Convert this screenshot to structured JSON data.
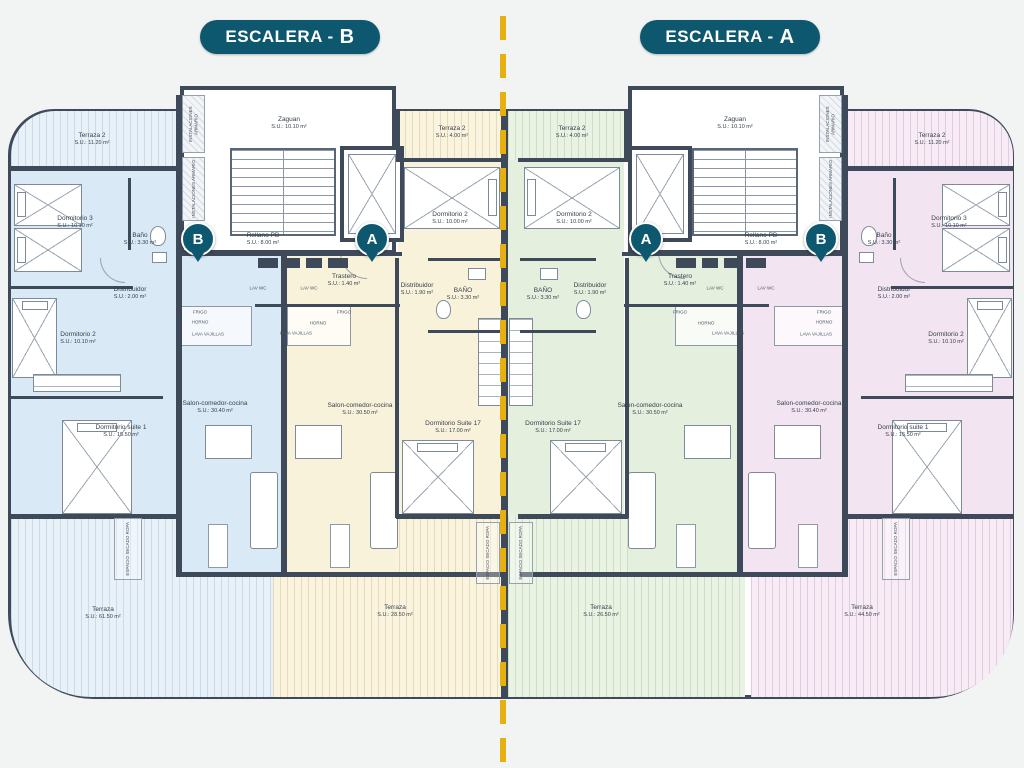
{
  "titles": {
    "b": {
      "prefix": "ESCALERA -",
      "letter": "B"
    },
    "a": {
      "prefix": "ESCALERA -",
      "letter": "A"
    }
  },
  "markers": {
    "b": "B",
    "a": "A"
  },
  "rooms": {
    "terraza2_large": {
      "name": "Terraza 2",
      "area": "S.U.: 11.20 m²"
    },
    "terraza2_small": {
      "name": "Terraza 2",
      "area": "S.U.: 4.00 m²"
    },
    "dormitorio3": {
      "name": "Dormitorio 3",
      "area": "S.U.: 10.10 m²"
    },
    "dormitorio2_side": {
      "name": "Dormitorio 2",
      "area": "S.U.: 10.10 m²"
    },
    "dormitorio2_center": {
      "name": "Dormitorio 2",
      "area": "S.U.: 10.00 m²"
    },
    "bano_side": {
      "name": "Baño",
      "area": "S.U.: 3.30 m²"
    },
    "bano_center": {
      "name": "BAÑO",
      "area": "S.U.: 3.30 m²"
    },
    "distribuidor_side": {
      "name": "Distribuidor",
      "area": "S.U.: 2.00 m²"
    },
    "distribuidor_center": {
      "name": "Distribuidor",
      "area": "S.U.: 1.90 m²"
    },
    "suite1": {
      "name": "Dormitorio suite 1",
      "area": "S.U.: 15.50 m²"
    },
    "suite17": {
      "name": "Dormitorio Suite 17",
      "area": "S.U.: 17.00 m²"
    },
    "salon_side": {
      "name": "Salon-comedor-cocina",
      "area": "S.U.: 30.40 m²"
    },
    "salon_center": {
      "name": "Salon-comedor-cocina",
      "area": "S.U.: 30.50 m²"
    },
    "trastero": {
      "name": "Trastero",
      "area": "S.U.: 1.40 m²"
    },
    "zaguan": {
      "name": "Zaguan",
      "area": "S.U.: 10.10 m²"
    },
    "rellano": {
      "name": "Rellano PB",
      "area": "S.U.: 8.00 m²"
    },
    "terraza_b": {
      "name": "Terraza",
      "area": "S.U.: 61.50 m²"
    },
    "terraza_b2": {
      "name": "Terraza",
      "area": "S.U.: 28.50 m²"
    },
    "terraza_a2": {
      "name": "Terraza",
      "area": "S.U.: 26.50 m²"
    },
    "terraza_a": {
      "name": "Terraza",
      "area": "S.U.: 44.50 m²"
    }
  },
  "annotations": {
    "secado": "ESPACIO SECADO ROPA",
    "instalaciones": "INSTALACIONES ARMARIO",
    "lav": "LAV WC",
    "frigo": "FRIGO",
    "horno": "HORNO",
    "lavavajillas": "LAVA VAJILLAS"
  },
  "colors": {
    "wall": "#3e4a5a",
    "teal": "#0e586f",
    "dash_line": "#e6b011",
    "zone_blue": "#d9e9f6",
    "zone_cream": "#f9f2da",
    "zone_green": "#e5efde",
    "zone_pink": "#f3e4f1"
  }
}
